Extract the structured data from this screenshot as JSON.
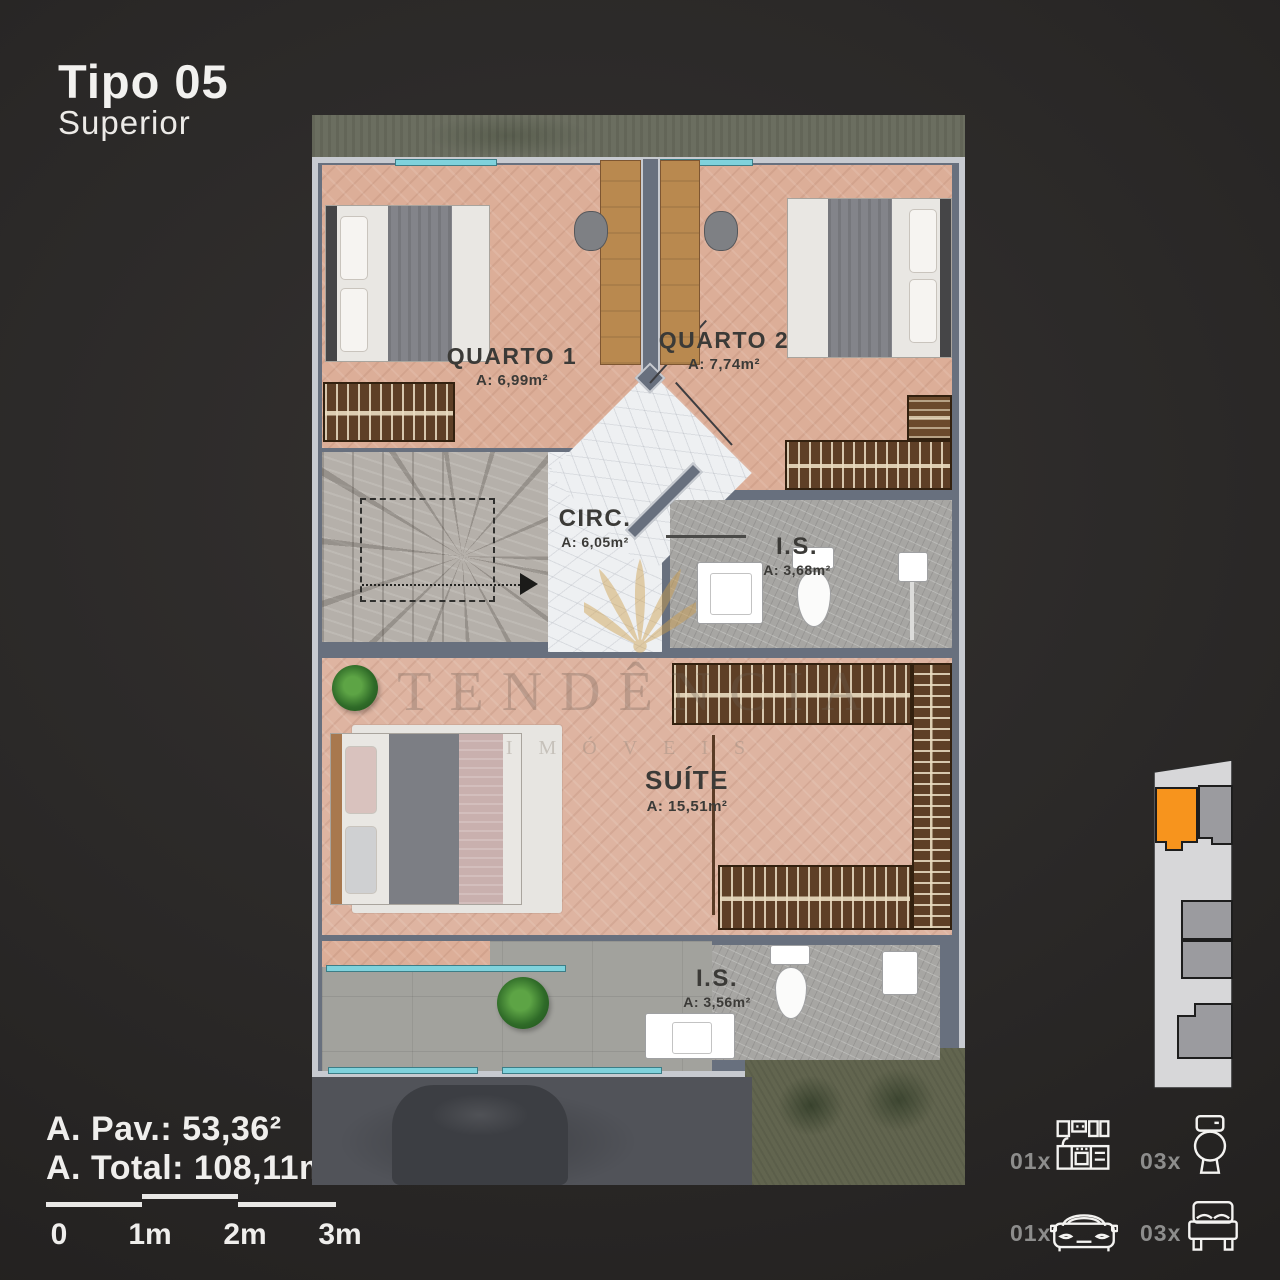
{
  "header": {
    "title": "Tipo 05",
    "subtitle": "Superior"
  },
  "plan": {
    "rooms": [
      {
        "name": "QUARTO 1",
        "area": "A: 6,99m²"
      },
      {
        "name": "QUARTO 2",
        "area": "A: 7,74m²"
      },
      {
        "name": "CIRC.",
        "area": "A: 6,05m²"
      },
      {
        "name": "I.S.",
        "area": "A: 3,68m²"
      },
      {
        "name": "SUÍTE",
        "area": "A: 15,51m²"
      },
      {
        "name": "I.S.",
        "area": "A: 3,56m²"
      }
    ]
  },
  "watermark": {
    "line1": "TENDÊNCIA",
    "line2": "IMÓVEIS"
  },
  "summary": {
    "pav": "A. Pav.: 53,36²",
    "total": "A. Total: 108,11m²"
  },
  "scalebar": {
    "labels": [
      "0",
      "1m",
      "2m",
      "3m"
    ]
  },
  "legend": {
    "items": [
      {
        "count": "01x",
        "icon": "kitchen-icon"
      },
      {
        "count": "03x",
        "icon": "toilet-icon"
      },
      {
        "count": "01x",
        "icon": "car-icon"
      },
      {
        "count": "03x",
        "icon": "bed-icon"
      }
    ]
  },
  "colors": {
    "accent_orange": "#f7941d",
    "window_cyan": "#7fd2dc",
    "wall": "#68707e",
    "wall_outline": "#c7cad0",
    "wood_floor": "#dcae98",
    "marble": "#eef0f2",
    "background": "#2b2928"
  }
}
